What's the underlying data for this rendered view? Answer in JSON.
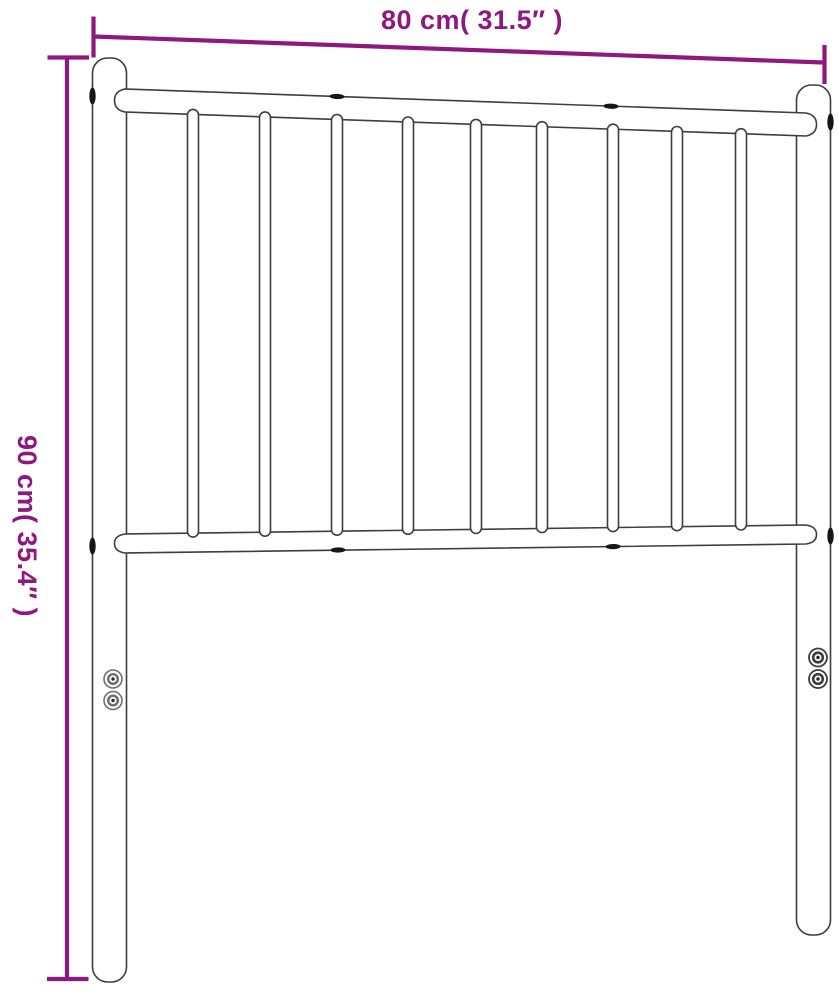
{
  "diagram": {
    "name": "metal-headboard-dimension-diagram",
    "description": "Line drawing of a metal bed headboard with two posts, top and bottom rails, nine vertical slats, and purple dimension annotations"
  },
  "dimensions": {
    "width": {
      "label": "80 cm( 31.5″ )",
      "cm": "80",
      "inches": "31.5"
    },
    "height": {
      "label": "90 cm( 35.4″ )",
      "cm": "90",
      "inches": "35.4"
    }
  },
  "colors": {
    "dimension_accent": "#8E1780",
    "outline": "#3E3E3E",
    "background": "#FFFFFF"
  }
}
